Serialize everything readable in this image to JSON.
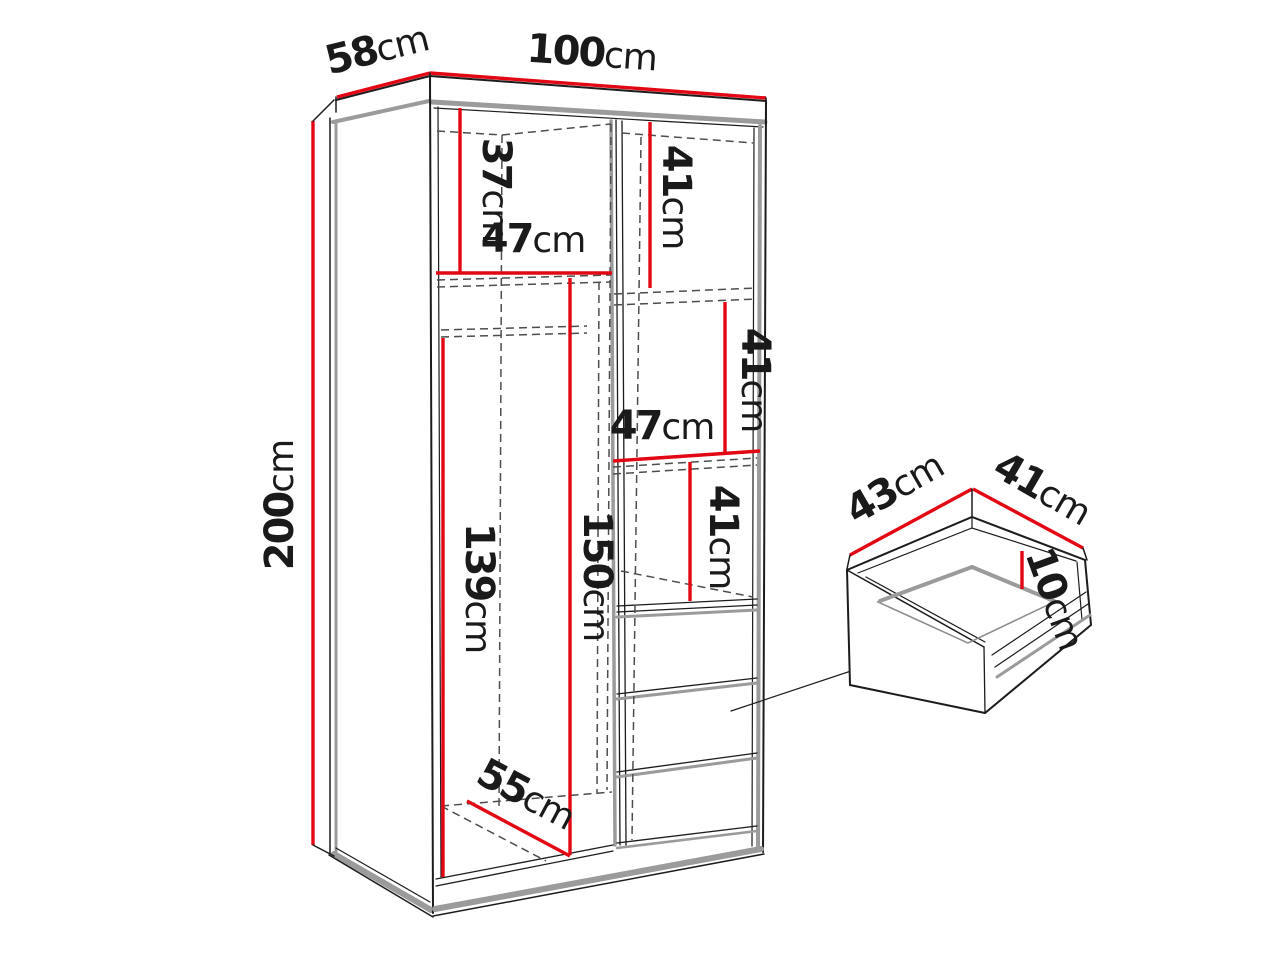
{
  "diagram": {
    "kind": "wardrobe-dimension-diagram",
    "colors": {
      "dimension_red": "#e30613",
      "outline_black": "#1c1c1c",
      "shade_gray": "#9b9b9b",
      "background": "#ffffff"
    }
  },
  "dims": {
    "depth_top": {
      "num": "58",
      "unit": "cm"
    },
    "width_top": {
      "num": "100",
      "unit": "cm"
    },
    "height_left": {
      "num": "200",
      "unit": "cm"
    },
    "left_top_section_height": {
      "num": "37",
      "unit": "cm"
    },
    "left_shelf_width": {
      "num": "47",
      "unit": "cm"
    },
    "right_top_section_height": {
      "num": "41",
      "unit": "cm"
    },
    "right_mid_section_height": {
      "num": "41",
      "unit": "cm"
    },
    "right_column_width": {
      "num": "47",
      "unit": "cm"
    },
    "right_lower_section_height": {
      "num": "41",
      "unit": "cm"
    },
    "hanging_height_front": {
      "num": "139",
      "unit": "cm"
    },
    "hanging_height_back": {
      "num": "150",
      "unit": "cm"
    },
    "floor_depth": {
      "num": "55",
      "unit": "cm"
    },
    "drawer_depth": {
      "num": "43",
      "unit": "cm"
    },
    "drawer_width": {
      "num": "41",
      "unit": "cm"
    },
    "drawer_height": {
      "num": "10",
      "unit": "cm"
    }
  }
}
